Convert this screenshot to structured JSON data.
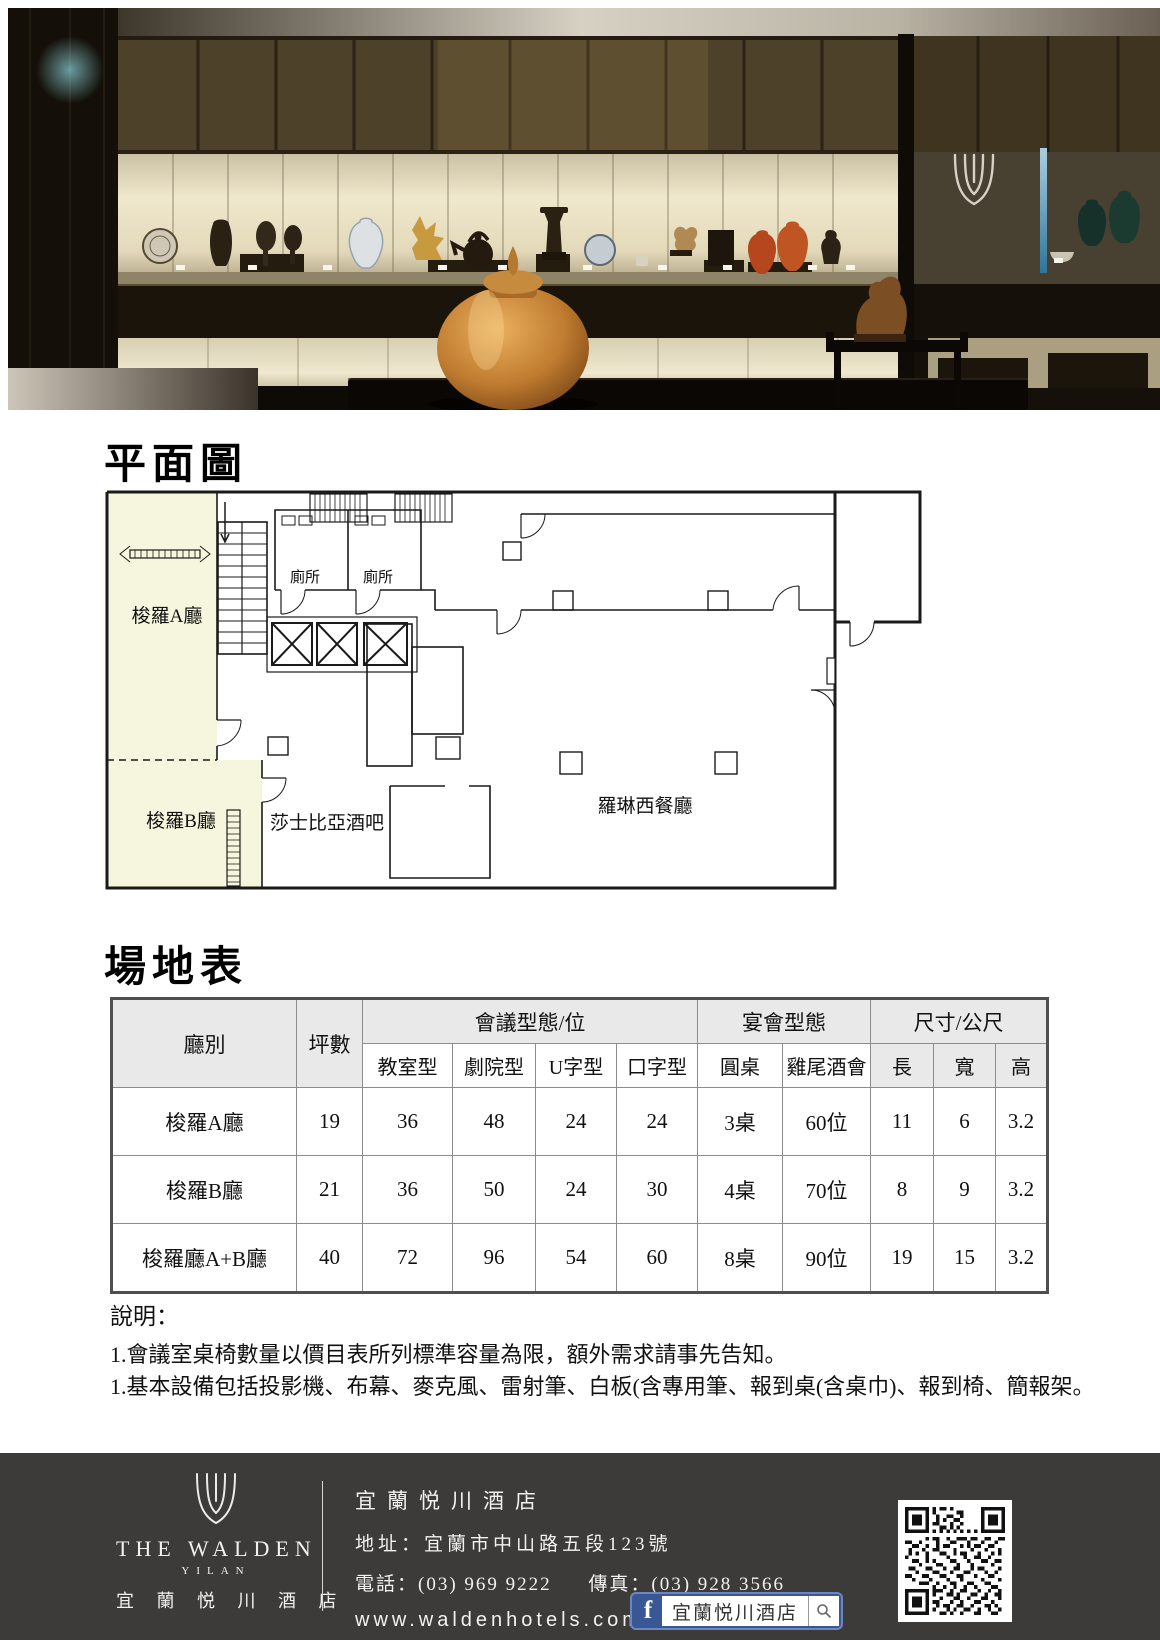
{
  "floor_plan": {
    "title": "平面圖",
    "rooms": {
      "hall_a": "梭羅A廳",
      "hall_b": "梭羅B廳",
      "toilet": "廁所",
      "bar": "莎士比亞酒吧",
      "restaurant": "羅琳西餐廳"
    }
  },
  "venue": {
    "title": "場地表",
    "table": {
      "col_hall": "廳別",
      "col_area": "坪數",
      "group_meeting": "會議型態/位",
      "group_banquet": "宴會型態",
      "group_size": "尺寸/公尺",
      "sub_classroom": "教室型",
      "sub_theater": "劇院型",
      "sub_u": "U字型",
      "sub_hollow": "口字型",
      "sub_round": "圓桌",
      "sub_cocktail": "雞尾酒會",
      "sub_length": "長",
      "sub_width": "寬",
      "sub_height": "高",
      "rows": [
        {
          "hall": "梭羅A廳",
          "area": "19",
          "classroom": "36",
          "theater": "48",
          "u": "24",
          "hollow": "24",
          "round": "3桌",
          "cocktail": "60位",
          "length": "11",
          "width": "6",
          "height": "3.2"
        },
        {
          "hall": "梭羅B廳",
          "area": "21",
          "classroom": "36",
          "theater": "50",
          "u": "24",
          "hollow": "30",
          "round": "4桌",
          "cocktail": "70位",
          "length": "8",
          "width": "9",
          "height": "3.2"
        },
        {
          "hall": "梭羅廳A+B廳",
          "area": "40",
          "classroom": "72",
          "theater": "96",
          "u": "54",
          "hollow": "60",
          "round": "8桌",
          "cocktail": "90位",
          "length": "19",
          "width": "15",
          "height": "3.2"
        }
      ]
    }
  },
  "notes": {
    "title": "說明：",
    "items": [
      "1.會議室桌椅數量以價目表所列標準容量為限，額外需求請事先告知。",
      "1.基本設備包括投影機、布幕、麥克風、雷射筆、白板(含專用筆、報到桌(含桌巾)、報到椅、簡報架。"
    ]
  },
  "footer": {
    "logo": {
      "en": "THE WALDEN",
      "sub_en": "YILAN",
      "zh": "宜 蘭 悦 川 酒 店"
    },
    "hotel_name": "宜蘭悦川酒店",
    "address": "地址：宜蘭市中山路五段123號",
    "phone": "電話：(03) 969 9222",
    "fax": "傳真：(03) 928 3566",
    "website": "www.waldenhotels.com",
    "facebook_label": "宜蘭悦川酒店"
  },
  "icons": {
    "facebook_f": "f"
  },
  "colors": {
    "facebook_blue": "#3a5795",
    "footer_bg": "#3c3b39",
    "room_fill": "#f5f6dd",
    "table_header_bg": "#e9e9e9"
  }
}
